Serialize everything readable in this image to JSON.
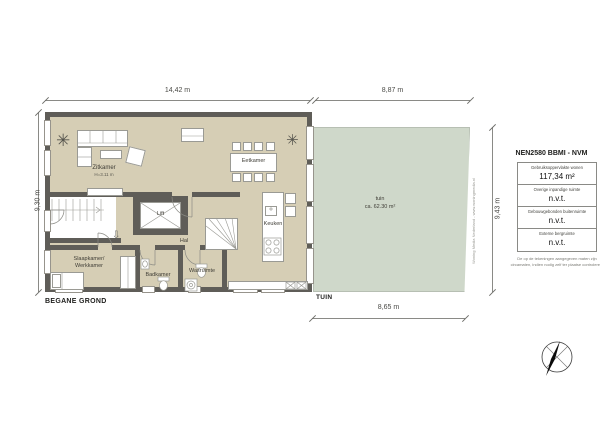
{
  "plan": {
    "floor_label": "BEGANE GROND",
    "garden_label": "TUIN",
    "entry_arrow_icon": "⇩",
    "plant_icon": "✳",
    "rooms": {
      "zitkamer": {
        "label": "Zitkamer",
        "height_note": "H=3.11 m"
      },
      "eetkamer": {
        "label": "Eetkamer"
      },
      "lift": {
        "label": "Lift"
      },
      "hal": {
        "label": "Hal"
      },
      "keuken": {
        "label": "Keuken"
      },
      "slaapkamer": {
        "line1": "Slaapkamer/",
        "line2": "Werkkamer"
      },
      "badkamer": {
        "label": "Badkamer"
      },
      "wasruimte": {
        "label": "Wasruimte"
      },
      "tuin": {
        "label": "tuin",
        "area": "ca. 62.30 m²"
      }
    },
    "dimensions": {
      "top_left": "14,42 m",
      "top_right": "8,87 m",
      "left": "9,30 m",
      "right": "9,43 m",
      "bottom": "8,65 m"
    }
  },
  "legend": {
    "title": "NEN2580 BBMI - NVM",
    "rows": [
      {
        "label": "Gebruiksoppervlakte wonen",
        "value": "117,34 m²"
      },
      {
        "label": "Overige inpandige ruimte",
        "value": "n.v.t."
      },
      {
        "label": "Gebouwgebonden buitenruimte",
        "value": "n.v.t."
      },
      {
        "label": "Externe bergruimte",
        "value": "n.v.t."
      }
    ],
    "footnote": "De op de tekeningen aangegeven maten zijn circamaten, indien nodig zelf ter plaatse controleren."
  },
  "credit": "Woning Media Nederland - www.woningmedia.nl",
  "colors": {
    "floor": "#d6ceb5",
    "garden": "#cfd8ca",
    "wall": "#5f5d58"
  }
}
